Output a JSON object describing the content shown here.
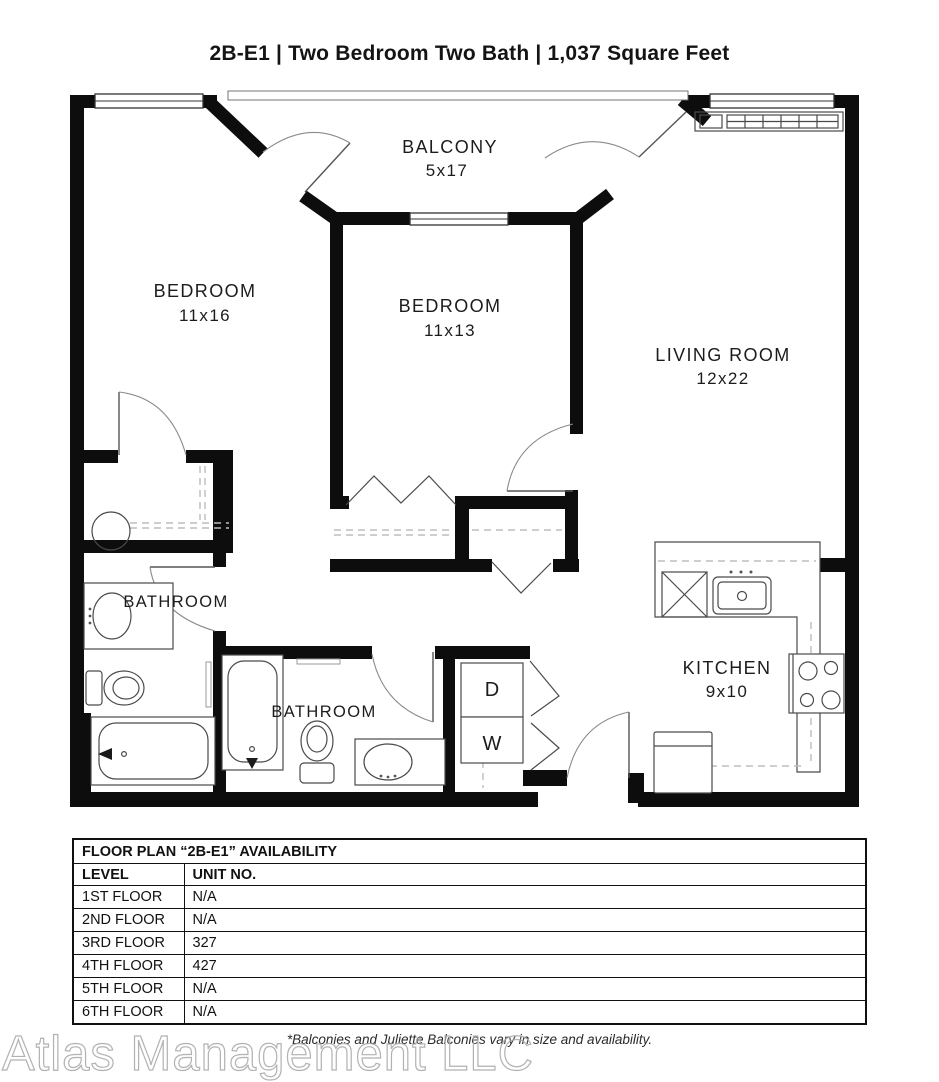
{
  "title": "2B-E1 | Two Bedroom Two Bath | 1,037 Square Feet",
  "floor_plan": {
    "rooms": [
      {
        "name": "BALCONY",
        "dimensions": "5x17"
      },
      {
        "name": "BEDROOM",
        "dimensions": "11x16"
      },
      {
        "name": "BEDROOM",
        "dimensions": "11x13"
      },
      {
        "name": "LIVING ROOM",
        "dimensions": "12x22"
      },
      {
        "name": "BATHROOM",
        "dimensions": ""
      },
      {
        "name": "BATHROOM",
        "dimensions": ""
      },
      {
        "name": "KITCHEN",
        "dimensions": "9x10"
      }
    ],
    "appliances": {
      "dryer": "D",
      "washer": "W"
    }
  },
  "availability_table": {
    "title": "FLOOR PLAN “2B-E1” AVAILABILITY",
    "columns": [
      "LEVEL",
      "UNIT NO."
    ],
    "rows": [
      {
        "level": "1ST FLOOR",
        "unit": "N/A"
      },
      {
        "level": "2ND FLOOR",
        "unit": "N/A"
      },
      {
        "level": "3RD FLOOR",
        "unit": "327"
      },
      {
        "level": "4TH FLOOR",
        "unit": "427"
      },
      {
        "level": "5TH FLOOR",
        "unit": "N/A"
      },
      {
        "level": "6TH FLOOR",
        "unit": "N/A"
      }
    ]
  },
  "footnote": "*Balconies and Juliette Balconies vary in size and availability.",
  "watermark": "Atlas Management LLC"
}
